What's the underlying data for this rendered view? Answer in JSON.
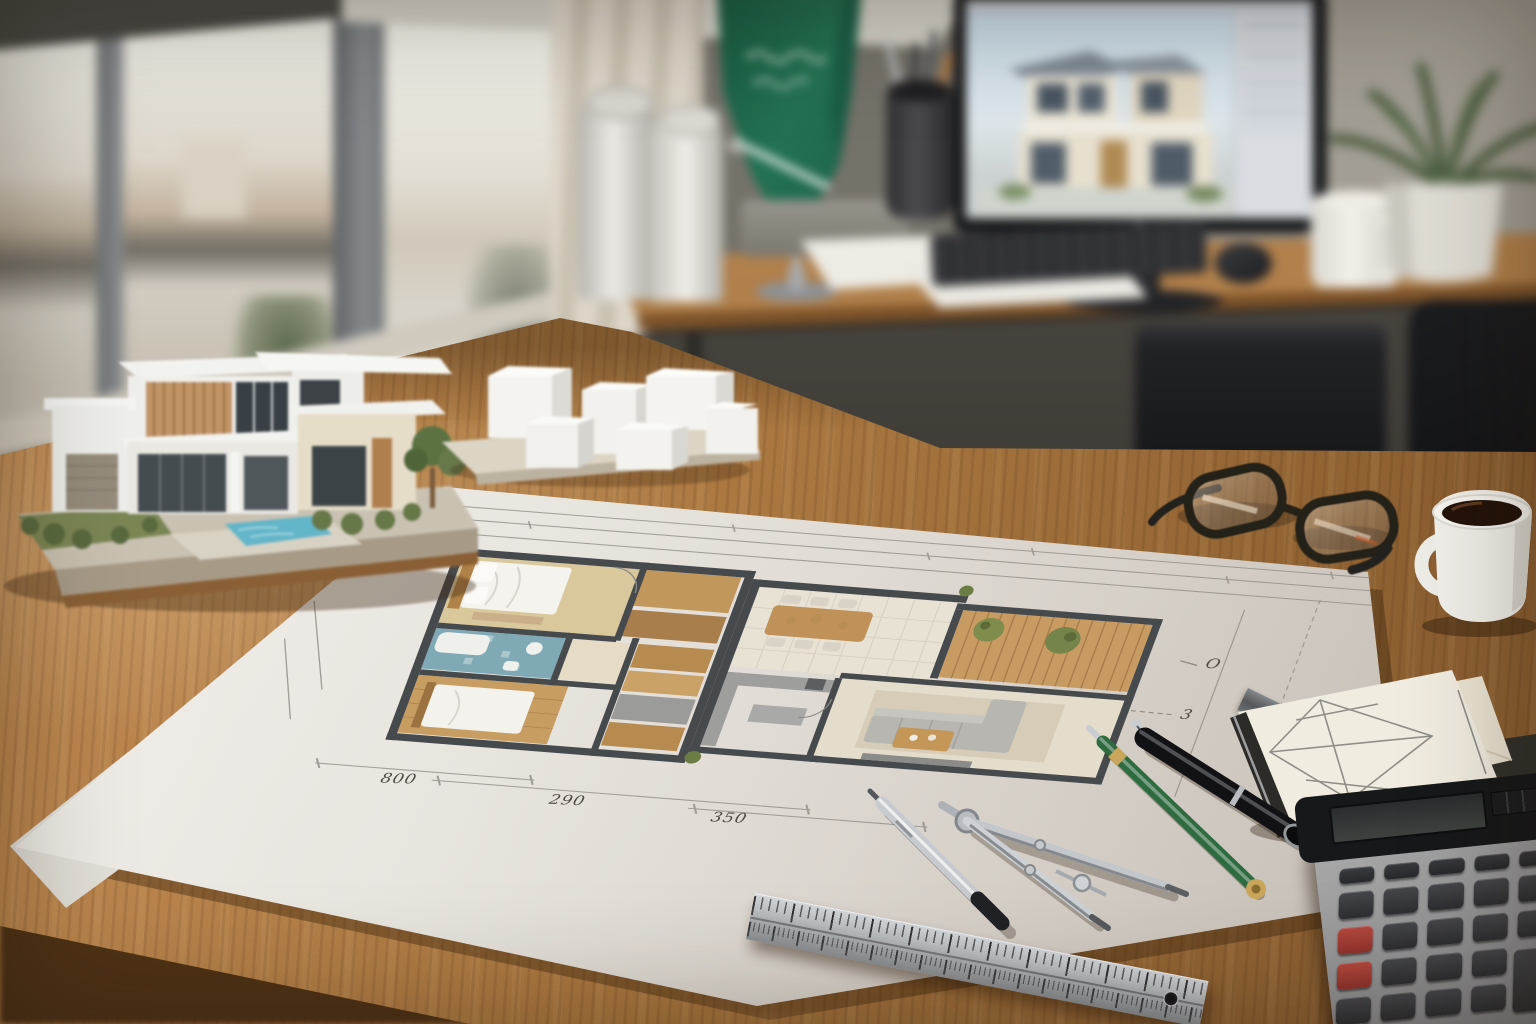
{
  "scene": {
    "description": "Architect's office desk: hand-drawn watercolor floor plan blueprint surrounded by drafting tools, a modern villa presentation model, white massing study blocks, and a blurred workstation showing a 3D house rendering",
    "lighting": "daylight from left window, shallow depth of field"
  },
  "palette": {
    "desk_wood": "#a9763f",
    "back_desk_wood": "#a07445",
    "wall": "#8d8a81",
    "paper": "#f2f0ec",
    "plan_wall": "#474a4d",
    "plan_wood": "#c79d62",
    "bathroom_tile": "#7fa9b5",
    "pool_blue": "#63b5c9",
    "deck_wood": "#c89b62",
    "flag_green": "#1e6a4b",
    "calculator_body": "#97979a",
    "calculator_red_key": "#a63f38",
    "pen_green": "#2e6b41",
    "metal": "#c6c9cd",
    "coffee": "#23130a",
    "plant_green": "#4c5f42"
  },
  "background": {
    "window": {
      "panes": 3,
      "view": "blurred city skyline with trees",
      "shade": "roller shade partially lowered"
    },
    "curtain": "beige",
    "flag": {
      "field": "green",
      "emblem": "white script above horizontal sword",
      "stand": "chrome pole on round base"
    },
    "rolled_blueprints": 2,
    "pen_cup": {
      "items": [
        "scissors",
        "dark pens",
        "orange pencil"
      ]
    },
    "workstation": {
      "monitor": {
        "content": "two-story house 3D rendering in design software",
        "ui": [
          "top toolbar",
          "right side panel"
        ]
      },
      "keyboard": "black",
      "mouse": "black",
      "paper_sheet": "white"
    },
    "mug_on_desk": "white",
    "plant": {
      "pot": "white ceramic",
      "foliage": "green fronds"
    },
    "printer": "black under desk",
    "office_chair": "black"
  },
  "desk_objects": {
    "house_model": {
      "style": "modern two-story villa",
      "features": [
        "white volumes",
        "wood slat facade",
        "dark glazing",
        "swimming pool",
        "garden greenery",
        "concrete base"
      ]
    },
    "massing_model": {
      "blocks": 6,
      "color": "white",
      "base": "wood board"
    },
    "glasses": "black rounded rectangular frames",
    "coffee_mug": {
      "color": "white",
      "contents": "black coffee"
    },
    "sketchbook": {
      "cover": "dark with metal edge",
      "sketch": "pencil perspective study with diamond grid"
    },
    "envelope": "cream",
    "document_folder": "dark gray",
    "scale_ruler": "dark metal, partly under sketchbook",
    "pens": [
      "green ballpoint with gold trim",
      "black fountain pen with silver band"
    ],
    "mechanical_pencil": "silver with black grip",
    "compass_divider": "stainless steel bow compass",
    "steel_ruler": {
      "type": "stainless rule with dual tick scales",
      "hole": "hanging hole near right end"
    },
    "calculator": {
      "body": "gray desktop calculator",
      "display": "dark LCD with solar strip",
      "keys": {
        "rows": 5,
        "columns": 5,
        "dark": "charcoal",
        "red_keys": 2,
        "wide_plus_key": true
      }
    }
  },
  "blueprint": {
    "type": "architectural floor plan, watercolor hand-drawn",
    "dim_labels": [
      "800",
      "290",
      "350"
    ],
    "annotations": [
      "O",
      "3"
    ],
    "rooms": [
      "bedroom",
      "bathroom",
      "bedroom",
      "closets",
      "dining area",
      "kitchen",
      "living room",
      "wood deck"
    ]
  }
}
